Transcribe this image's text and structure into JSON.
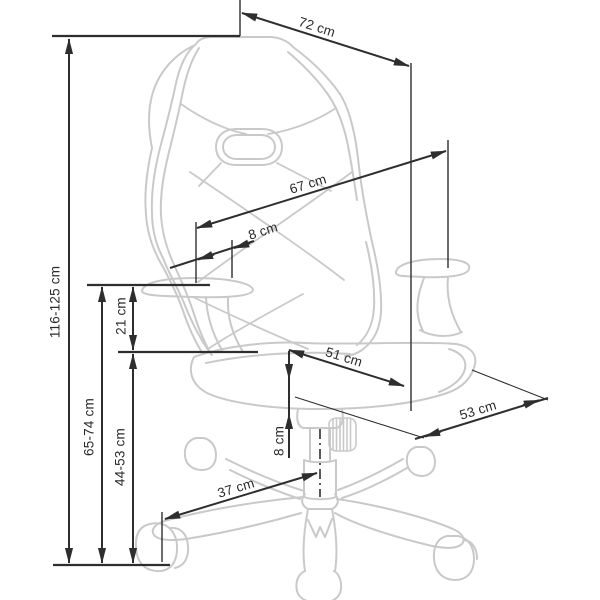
{
  "diagram": {
    "subject": "Gaming chair dimension drawing, three-quarter view",
    "unit": "cm",
    "background": "#ffffff",
    "colors": {
      "dimension_lines": "#2e2e2e",
      "chair_outline": "#c9c9c9"
    },
    "labels": {
      "backrest_top_width": "72 cm",
      "backrest_diagonal_height": "67 cm",
      "backrest_armrest_offset": "8 cm",
      "seat_width": "51 cm",
      "seat_depth": "53 cm",
      "armrest_above_seat": "21 cm",
      "gas_lift_range": "8 cm",
      "base_span": "37 cm",
      "total_height": "116-125 cm",
      "armrest_height": "65-74 cm",
      "seat_height": "44-53 cm"
    }
  }
}
